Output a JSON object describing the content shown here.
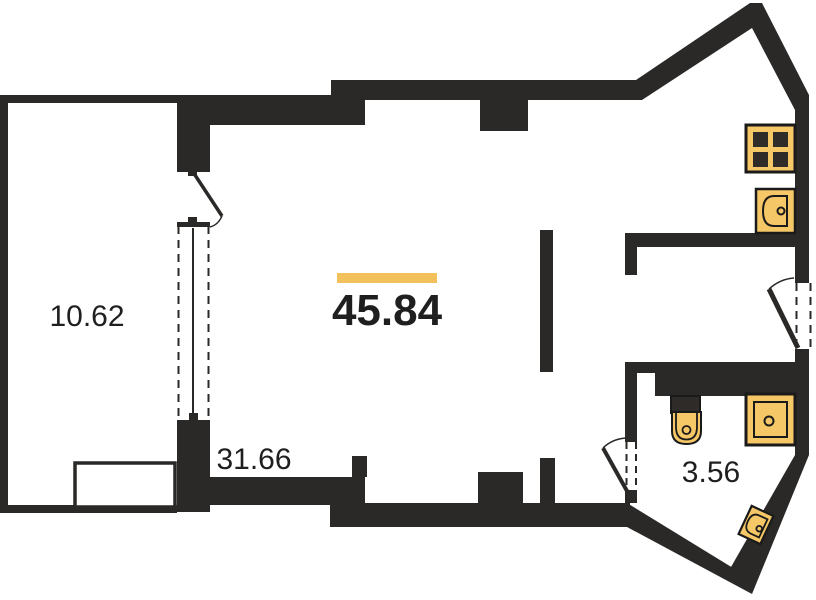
{
  "plan": {
    "type": "apartment-floor-plan",
    "rooms": [
      {
        "id": "balcony",
        "area": "10.62",
        "highlighted": false
      },
      {
        "id": "main-room",
        "area": "45.84",
        "highlighted": true
      },
      {
        "id": "lower-area",
        "area": "31.66",
        "highlighted": false
      },
      {
        "id": "bathroom",
        "area": "3.56",
        "highlighted": false
      }
    ],
    "icons": [
      "stove-icon",
      "kitchen-sink-icon",
      "toilet-icon",
      "shower-tray-icon",
      "corner-sink-icon",
      "balcony-door-swing",
      "entry-door-swing",
      "bathroom-door-swing",
      "window-symbol"
    ]
  },
  "colors": {
    "background": "#ffffff",
    "wall": "#2b2927",
    "accent": "#f2c15c",
    "fixture_fill": "#f5c766",
    "fixture_dark": "#2e2b28",
    "fixture_stroke": "#1a1a1a",
    "text": "#1f1f1f"
  }
}
